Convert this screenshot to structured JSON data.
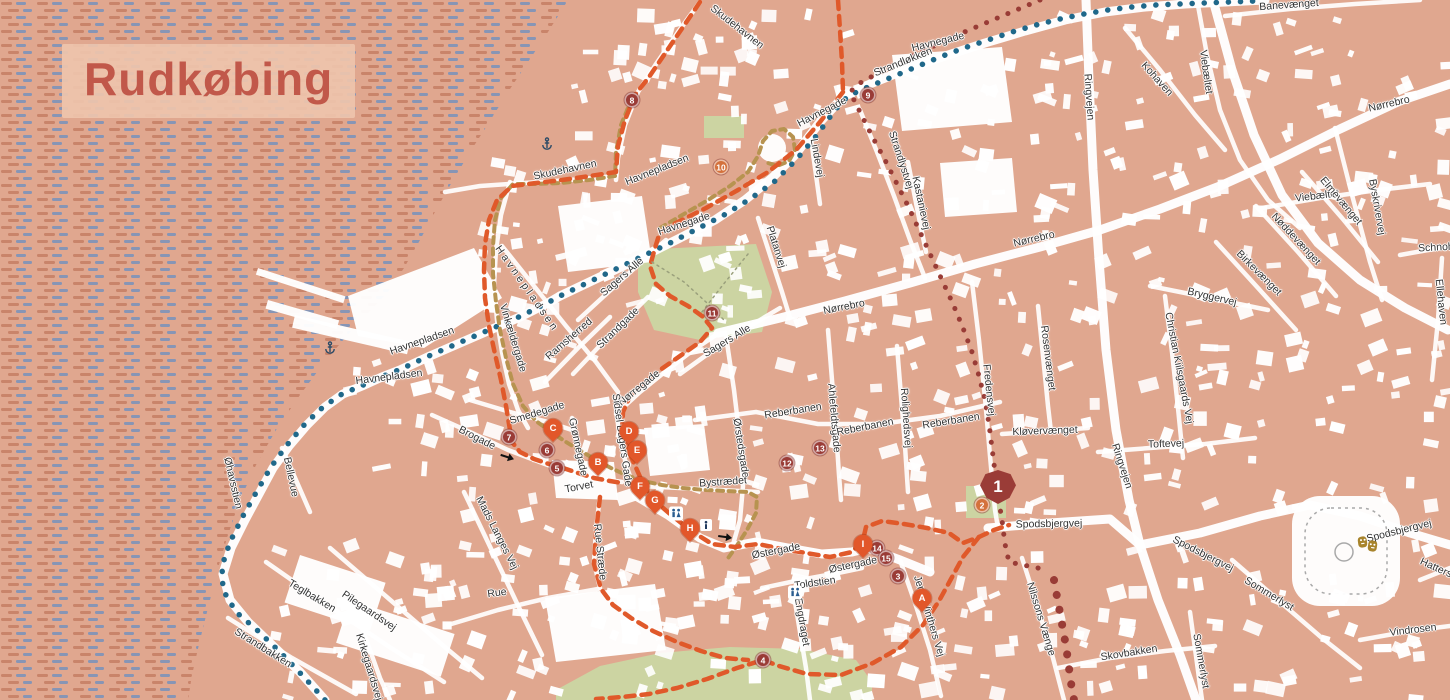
{
  "title": "Rudkøbing",
  "colors": {
    "land": "#e0a78f",
    "water_dash_warm": "#c9846a",
    "water_dash_blue": "#8795b5",
    "building": "#ffffff",
    "park": "#ccd4a2",
    "route_orange": "#e0592a",
    "route_teal": "#20688a",
    "route_maroon": "#993c36",
    "route_tan": "#b79350",
    "marker_maroon": "#9a3c37",
    "marker_orange": "#d4713c",
    "pin_orange": "#e2572a",
    "label_text": "#333333",
    "title_text": "#c1584a",
    "title_bg": "#eec4ac",
    "icon_navy": "#2a5d8f",
    "theater_gold": "#a8842c"
  },
  "street_labels": [
    {
      "t": "Skudehavnen",
      "x": 737,
      "y": 27,
      "r": 38
    },
    {
      "t": "Skudehavnen",
      "x": 565,
      "y": 170,
      "r": -12
    },
    {
      "t": "Havnepladsen",
      "x": 657,
      "y": 170,
      "r": -22
    },
    {
      "t": "Havnegade",
      "x": 938,
      "y": 42,
      "r": -14
    },
    {
      "t": "Strandløkken",
      "x": 903,
      "y": 62,
      "r": -22
    },
    {
      "t": "Havnegade",
      "x": 822,
      "y": 112,
      "r": -27
    },
    {
      "t": "Lindevej",
      "x": 817,
      "y": 158,
      "r": 80
    },
    {
      "t": "Strandlystvej",
      "x": 901,
      "y": 160,
      "r": 72
    },
    {
      "t": "Kastanievej",
      "x": 921,
      "y": 203,
      "r": 78
    },
    {
      "t": "Havnegade",
      "x": 684,
      "y": 224,
      "r": -18
    },
    {
      "t": "Platanvej",
      "x": 776,
      "y": 247,
      "r": 72
    },
    {
      "t": "Nørrebro",
      "x": 1034,
      "y": 239,
      "r": -13
    },
    {
      "t": "Nørrebro",
      "x": 844,
      "y": 307,
      "r": -11
    },
    {
      "t": "Nørrebro",
      "x": 1389,
      "y": 104,
      "r": -13
    },
    {
      "t": "Banevænget",
      "x": 1289,
      "y": 5,
      "r": -4
    },
    {
      "t": "Viebæltet",
      "x": 1206,
      "y": 72,
      "r": 82
    },
    {
      "t": "Viebæltet",
      "x": 1317,
      "y": 196,
      "r": -7
    },
    {
      "t": "Kohaven",
      "x": 1157,
      "y": 79,
      "r": 48
    },
    {
      "t": "Ringvejen",
      "x": 1089,
      "y": 97,
      "r": 86
    },
    {
      "t": "Ringvejen",
      "x": 1122,
      "y": 466,
      "r": 72
    },
    {
      "t": "Byskrivervej",
      "x": 1377,
      "y": 207,
      "r": 80
    },
    {
      "t": "Elmevænget",
      "x": 1341,
      "y": 201,
      "r": 50
    },
    {
      "t": "Nøddevænget",
      "x": 1296,
      "y": 239,
      "r": 47
    },
    {
      "t": "Birkevænget",
      "x": 1259,
      "y": 273,
      "r": 45
    },
    {
      "t": "Schnohrsvej",
      "x": 1447,
      "y": 247,
      "r": -3
    },
    {
      "t": "Ellehaven",
      "x": 1441,
      "y": 302,
      "r": 84
    },
    {
      "t": "Bryggervej",
      "x": 1212,
      "y": 297,
      "r": 13
    },
    {
      "t": "Rosenvænget",
      "x": 1048,
      "y": 358,
      "r": 83
    },
    {
      "t": "Christian Kiilsgaards Vej",
      "x": 1179,
      "y": 368,
      "r": 79
    },
    {
      "t": "Toftevej",
      "x": 1166,
      "y": 444,
      "r": -2
    },
    {
      "t": "Kløvervænget",
      "x": 1045,
      "y": 431,
      "r": -2
    },
    {
      "t": "Sagers Alle",
      "x": 622,
      "y": 277,
      "r": -41
    },
    {
      "t": "Sagers Alle",
      "x": 727,
      "y": 341,
      "r": -31
    },
    {
      "t": "Strandgade",
      "x": 618,
      "y": 328,
      "r": -44
    },
    {
      "t": "Ramsherred",
      "x": 569,
      "y": 339,
      "r": -41
    },
    {
      "t": "Vinkældergade",
      "x": 513,
      "y": 338,
      "r": 73
    },
    {
      "t": "Havnepladsen",
      "x": 527,
      "y": 289,
      "r": 55,
      "ls": 3
    },
    {
      "t": "Havnepladsen",
      "x": 422,
      "y": 341,
      "r": -19
    },
    {
      "t": "Havnepladsen",
      "x": 389,
      "y": 377,
      "r": -7
    },
    {
      "t": "Øhavsstien",
      "x": 233,
      "y": 483,
      "r": 77
    },
    {
      "t": "Bellevue",
      "x": 291,
      "y": 477,
      "r": 78
    },
    {
      "t": "Brogade",
      "x": 477,
      "y": 438,
      "r": 27
    },
    {
      "t": "Smedegade",
      "x": 537,
      "y": 413,
      "r": -17
    },
    {
      "t": "Grønnegade",
      "x": 578,
      "y": 447,
      "r": 78
    },
    {
      "t": "Nørregade",
      "x": 639,
      "y": 388,
      "r": -39
    },
    {
      "t": "Sidsel Bagers Gade",
      "x": 622,
      "y": 440,
      "r": 82
    },
    {
      "t": "Torvet",
      "x": 579,
      "y": 487,
      "r": -11
    },
    {
      "t": "Rue Stræde",
      "x": 600,
      "y": 552,
      "r": 84
    },
    {
      "t": "Rue",
      "x": 497,
      "y": 593,
      "r": -8
    },
    {
      "t": "Mads Langes Vej",
      "x": 497,
      "y": 533,
      "r": 63
    },
    {
      "t": "Teglbakken",
      "x": 312,
      "y": 596,
      "r": 31
    },
    {
      "t": "Pilegaardsvej",
      "x": 369,
      "y": 611,
      "r": 34
    },
    {
      "t": "Kirkegaardsvej",
      "x": 369,
      "y": 667,
      "r": 73
    },
    {
      "t": "Strandbakken",
      "x": 263,
      "y": 648,
      "r": 32
    },
    {
      "t": "Østergade",
      "x": 776,
      "y": 551,
      "r": -11
    },
    {
      "t": "Østergade",
      "x": 853,
      "y": 565,
      "r": -12
    },
    {
      "t": "Toldstien",
      "x": 815,
      "y": 583,
      "r": -8
    },
    {
      "t": "Engdraget",
      "x": 802,
      "y": 622,
      "r": 80
    },
    {
      "t": "Jens Winthers Vej",
      "x": 929,
      "y": 616,
      "r": 73
    },
    {
      "t": "Ørstedsgade",
      "x": 741,
      "y": 448,
      "r": 81
    },
    {
      "t": "Bystrædet",
      "x": 723,
      "y": 482,
      "r": -4
    },
    {
      "t": "Ahlefeldtsgade",
      "x": 834,
      "y": 418,
      "r": 85
    },
    {
      "t": "Rolighedsvej",
      "x": 906,
      "y": 418,
      "r": 86
    },
    {
      "t": "Reberbanen",
      "x": 793,
      "y": 411,
      "r": -9
    },
    {
      "t": "Reberbanen",
      "x": 865,
      "y": 427,
      "r": -11
    },
    {
      "t": "Reberbanen",
      "x": 951,
      "y": 421,
      "r": -9
    },
    {
      "t": "Fredensvej",
      "x": 989,
      "y": 390,
      "r": 84
    },
    {
      "t": "Spodsbjergvej",
      "x": 1049,
      "y": 524,
      "r": -1
    },
    {
      "t": "Spodsbjergvej",
      "x": 1203,
      "y": 554,
      "r": 27
    },
    {
      "t": "Spodsbjergvej",
      "x": 1399,
      "y": 531,
      "r": -14
    },
    {
      "t": "Nilssons Vænge",
      "x": 1041,
      "y": 619,
      "r": 73
    },
    {
      "t": "Skovbakken",
      "x": 1129,
      "y": 653,
      "r": -9
    },
    {
      "t": "Sommerlyst",
      "x": 1269,
      "y": 594,
      "r": 31
    },
    {
      "t": "Sommerlyst",
      "x": 1201,
      "y": 661,
      "r": 80
    },
    {
      "t": "Vindrosen",
      "x": 1413,
      "y": 630,
      "r": -7
    },
    {
      "t": "Hattersvænget",
      "x": 1452,
      "y": 575,
      "r": 24
    }
  ],
  "markers": {
    "numbered": [
      {
        "label": "1",
        "x": 998,
        "y": 487,
        "variant": "badge"
      },
      {
        "label": "2",
        "x": 982,
        "y": 505,
        "variant": "orange"
      },
      {
        "label": "3",
        "x": 898,
        "y": 576,
        "variant": "maroon"
      },
      {
        "label": "4",
        "x": 763,
        "y": 660,
        "variant": "maroon"
      },
      {
        "label": "5",
        "x": 557,
        "y": 468,
        "variant": "maroon"
      },
      {
        "label": "6",
        "x": 547,
        "y": 450,
        "variant": "maroon"
      },
      {
        "label": "7",
        "x": 509,
        "y": 437,
        "variant": "maroon"
      },
      {
        "label": "8",
        "x": 632,
        "y": 100,
        "variant": "maroon"
      },
      {
        "label": "9",
        "x": 868,
        "y": 95,
        "variant": "maroon"
      },
      {
        "label": "10",
        "x": 721,
        "y": 167,
        "variant": "orange"
      },
      {
        "label": "11",
        "x": 712,
        "y": 313,
        "variant": "maroon"
      },
      {
        "label": "12",
        "x": 787,
        "y": 463,
        "variant": "maroon"
      },
      {
        "label": "13",
        "x": 820,
        "y": 448,
        "variant": "maroon"
      },
      {
        "label": "14",
        "x": 877,
        "y": 548,
        "variant": "maroon"
      },
      {
        "label": "15",
        "x": 886,
        "y": 558,
        "variant": "maroon"
      }
    ],
    "lettered": [
      {
        "label": "A",
        "x": 922,
        "y": 604
      },
      {
        "label": "B",
        "x": 598,
        "y": 468
      },
      {
        "label": "C",
        "x": 553,
        "y": 434
      },
      {
        "label": "D",
        "x": 629,
        "y": 437
      },
      {
        "label": "E",
        "x": 637,
        "y": 456
      },
      {
        "label": "F",
        "x": 640,
        "y": 492
      },
      {
        "label": "G",
        "x": 655,
        "y": 506
      },
      {
        "label": "H",
        "x": 690,
        "y": 534
      },
      {
        "label": "I",
        "x": 863,
        "y": 550
      }
    ]
  },
  "icons": [
    {
      "type": "restroom",
      "x": 676,
      "y": 516
    },
    {
      "type": "restroom",
      "x": 795,
      "y": 595
    },
    {
      "type": "info",
      "x": 706,
      "y": 527
    },
    {
      "type": "anchor",
      "x": 330,
      "y": 350
    },
    {
      "type": "anchor",
      "x": 547,
      "y": 146
    },
    {
      "type": "theater",
      "x": 1368,
      "y": 547
    },
    {
      "type": "arrow",
      "x": 507,
      "y": 458,
      "rot": 18
    },
    {
      "type": "arrow",
      "x": 725,
      "y": 538,
      "rot": 8
    }
  ]
}
